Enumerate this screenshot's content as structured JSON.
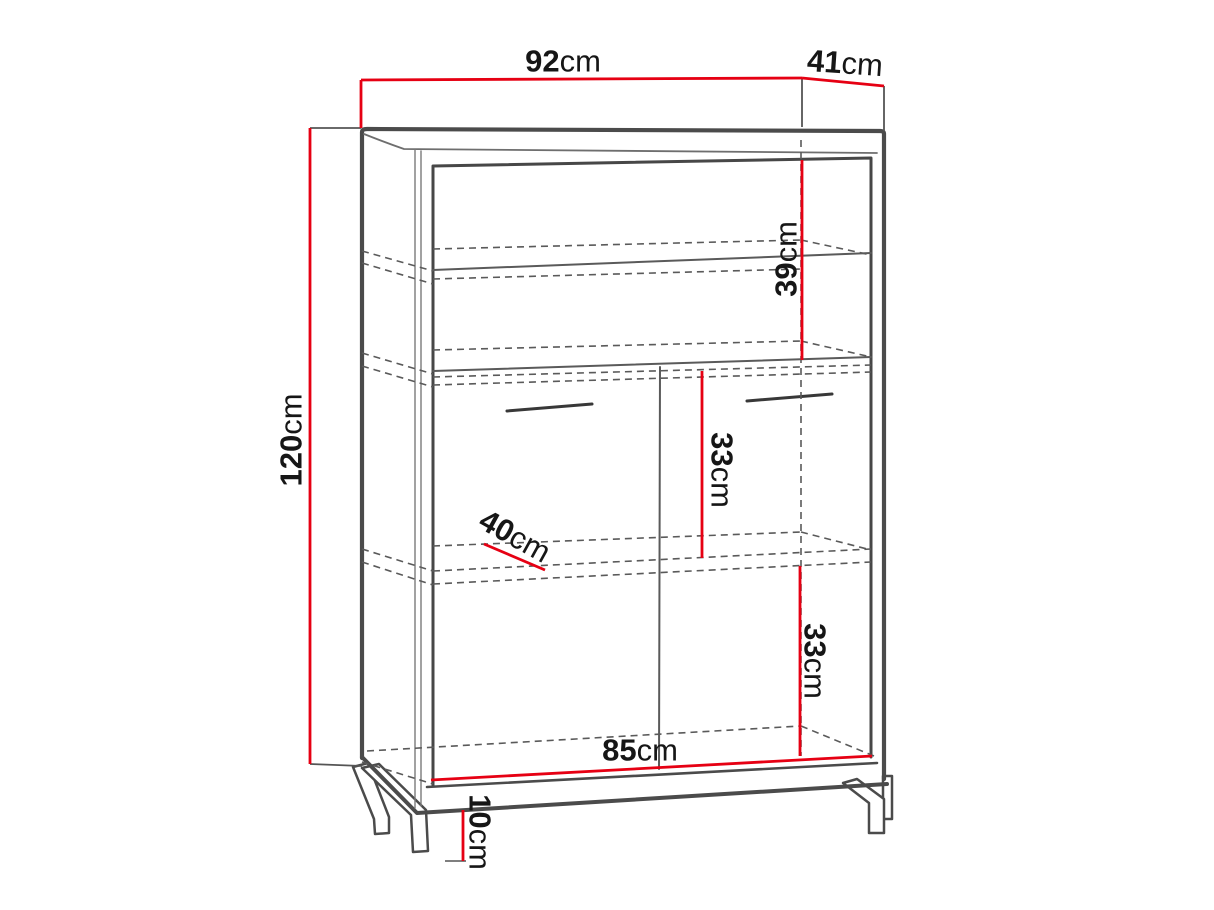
{
  "diagram": {
    "type": "furniture-dimension-drawing",
    "subject": "two-door cabinet with shelves on metal legs",
    "colors": {
      "dimension_line": "#e60013",
      "outline": "#4b4b4b",
      "dashed_line": "#5a5a5a",
      "label_text": "#161616",
      "background": "#ffffff"
    },
    "dims": {
      "width": {
        "value": "92",
        "unit": "cm",
        "meaning": "overall top width"
      },
      "depth": {
        "value": "41",
        "unit": "cm",
        "meaning": "overall top depth"
      },
      "height": {
        "value": "120",
        "unit": "cm",
        "meaning": "overall height"
      },
      "top_section": {
        "value": "39",
        "unit": "cm",
        "meaning": "upper open section height"
      },
      "middle_section": {
        "value": "33",
        "unit": "cm",
        "meaning": "middle inner section height"
      },
      "shelf_depth": {
        "value": "40",
        "unit": "cm",
        "meaning": "shelf depth"
      },
      "bottom_section": {
        "value": "33",
        "unit": "cm",
        "meaning": "lower inner section height"
      },
      "inner_width": {
        "value": "85",
        "unit": "cm",
        "meaning": "interior width"
      },
      "leg_height": {
        "value": "10",
        "unit": "cm",
        "meaning": "leg height"
      }
    }
  }
}
